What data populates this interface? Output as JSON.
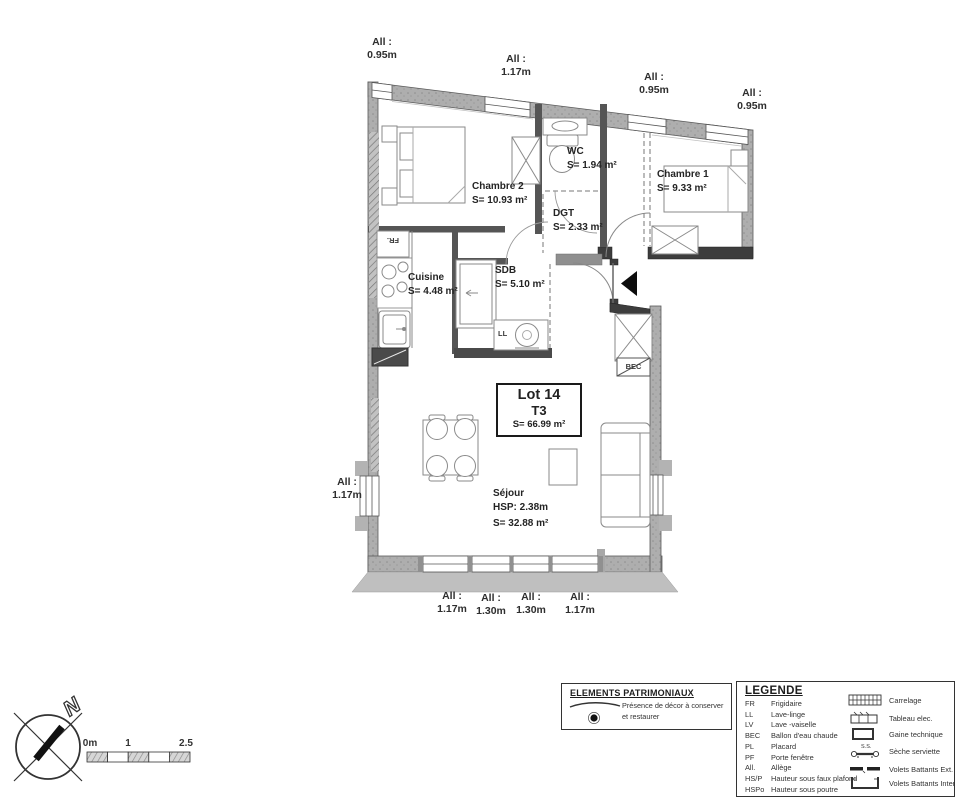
{
  "plan": {
    "lot_box": {
      "lot": "Lot 14",
      "type": "T3",
      "area": "S= 66.99 m²"
    },
    "rooms": {
      "chambre2": {
        "name": "Chambre 2",
        "area": "S= 10.93 m²"
      },
      "wc": {
        "name": "WC",
        "area": "S= 1.94 m²"
      },
      "chambre1": {
        "name": "Chambre 1",
        "area": "S= 9.33 m²"
      },
      "dgt": {
        "name": "DGT",
        "area": "S= 2.33 m²"
      },
      "cuisine": {
        "name": "Cuisine",
        "area": "S= 4.48 m²"
      },
      "sdb": {
        "name": "SDB",
        "area": "S= 5.10 m²"
      },
      "sejour": {
        "name": "Séjour",
        "hsp": "HSP: 2.38m",
        "area": "S= 32.88 m²"
      }
    },
    "window_labels": {
      "prefix": "All :",
      "top": [
        "0.95m",
        "1.17m",
        "0.95m",
        "0.95m"
      ],
      "left": "1.17m",
      "bottom": [
        "1.17m",
        "1.30m",
        "1.30m",
        "1.17m"
      ]
    },
    "fixtures": {
      "fridge": "FR.",
      "washer": "LL",
      "boiler": "BEC"
    }
  },
  "patrimoniaux": {
    "title": "ELEMENTS PATRIMONIAUX",
    "line1": "Présence de décor à conserver",
    "line2": "et restaurer"
  },
  "legende": {
    "title": "LEGENDE",
    "abbreviations": [
      {
        "abbr": "FR",
        "label": "Frigidaire"
      },
      {
        "abbr": "LL",
        "label": "Lave-linge"
      },
      {
        "abbr": "LV",
        "label": "Lave -vaiselle"
      },
      {
        "abbr": "BEC",
        "label": "Ballon d'eau chaude"
      },
      {
        "abbr": "PL",
        "label": "Placard"
      },
      {
        "abbr": "PF",
        "label": "Porte fenêtre"
      },
      {
        "abbr": "All.",
        "label": "Allège"
      },
      {
        "abbr": "HS/P",
        "label": "Hauteur sous faux plafond"
      },
      {
        "abbr": "HSPo",
        "label": "Hauteur sous poutre"
      }
    ],
    "symbols": [
      {
        "icon": "carrelage-grid",
        "label": "Carrelage"
      },
      {
        "icon": "tableau-elec",
        "label": "Tableau elec."
      },
      {
        "icon": "gaine-technique",
        "label": "Gaine technique"
      },
      {
        "icon": "seche-serviette",
        "label": "Sèche serviette",
        "tag": "S.S."
      },
      {
        "icon": "volets-ext",
        "label": "Volets Battants Ext."
      },
      {
        "icon": "volets-inter",
        "label": "Volets Battants Inter"
      }
    ]
  },
  "compass": {
    "north": "N"
  },
  "scale_bar": {
    "labels": [
      "0m",
      "1",
      "2.5"
    ]
  }
}
